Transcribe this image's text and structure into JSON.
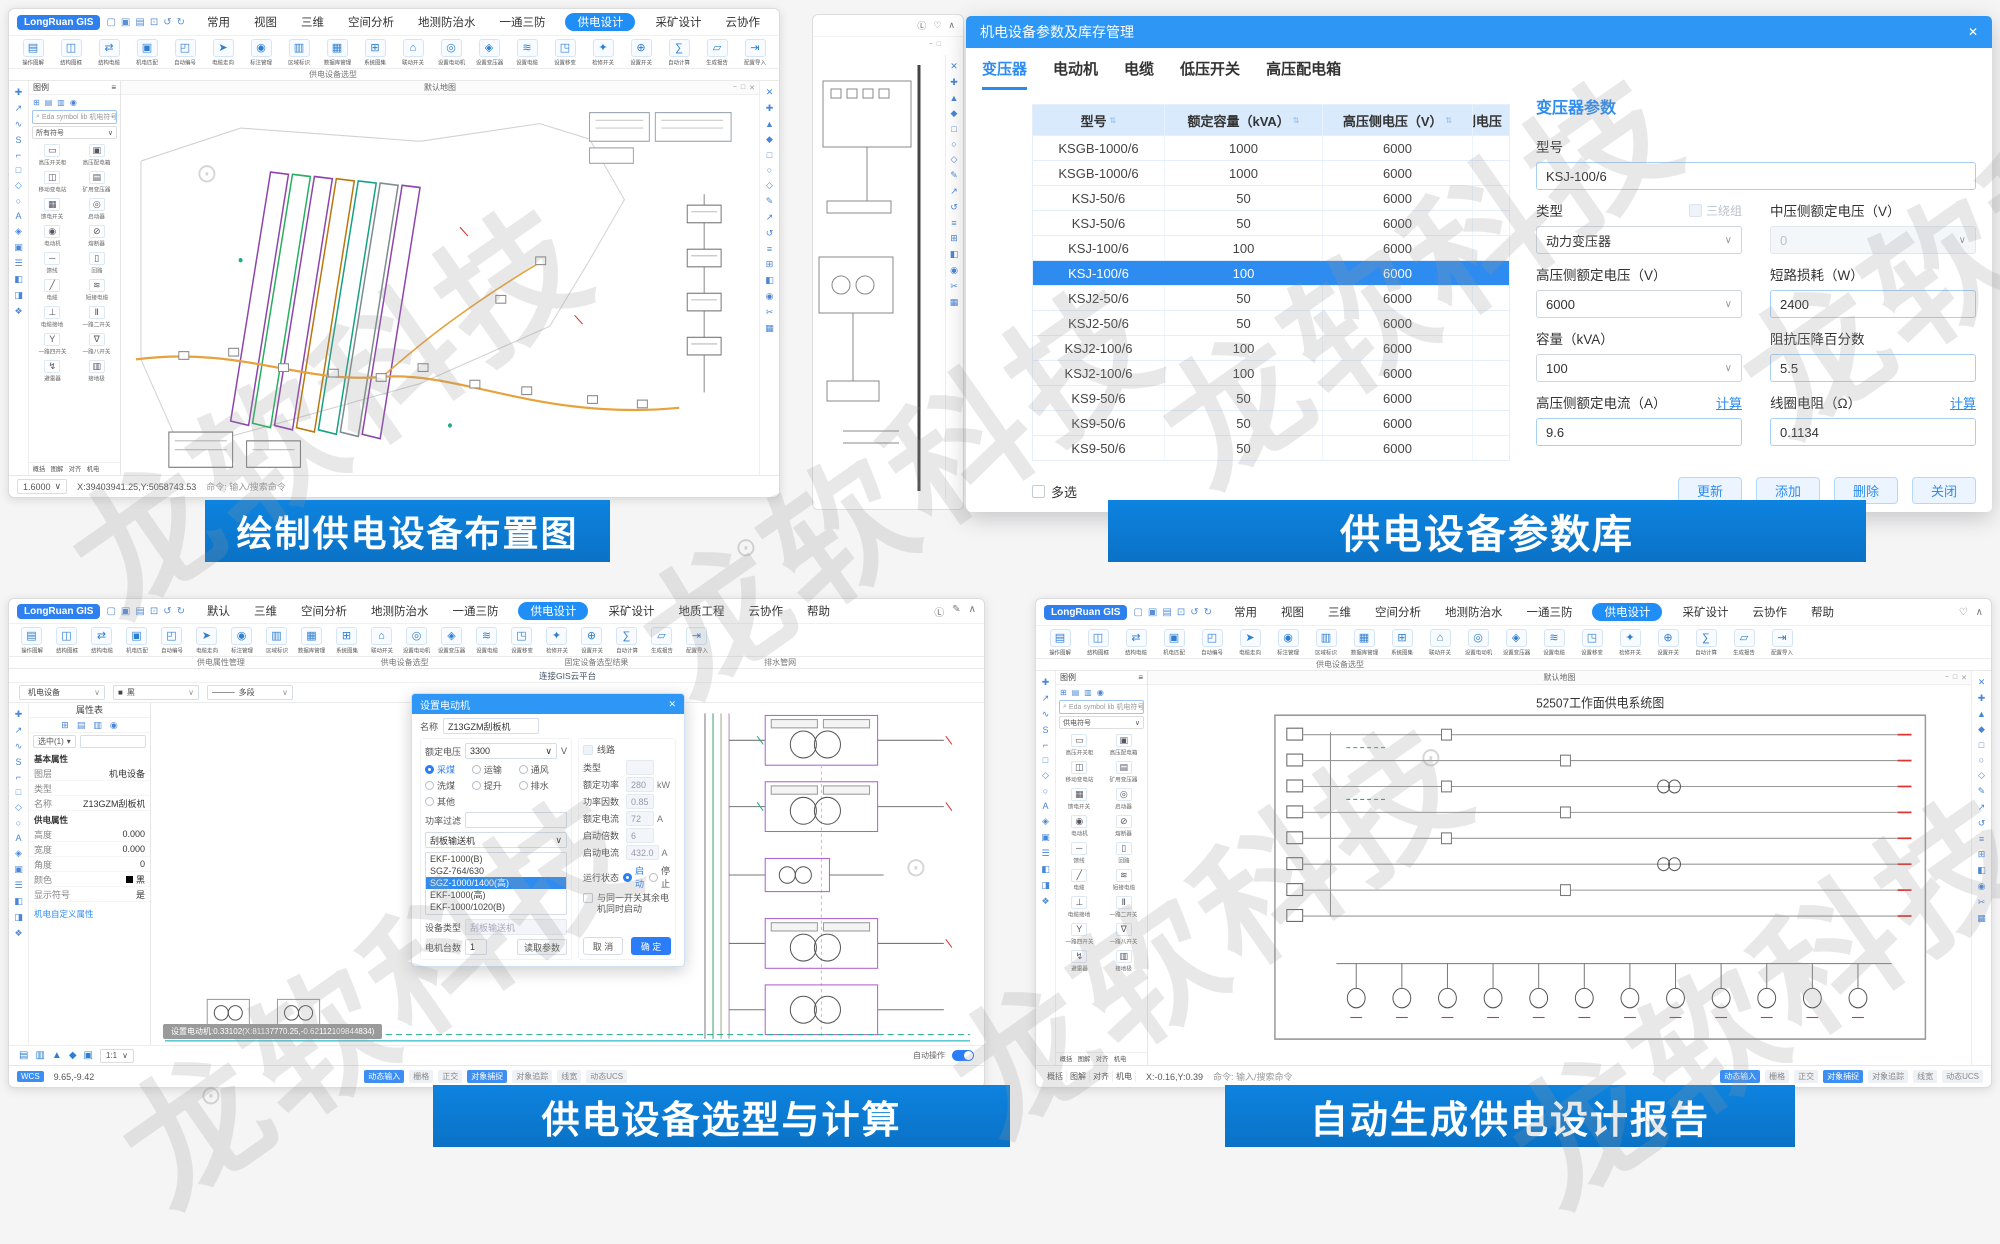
{
  "icons": {
    "caret": "∨",
    "close": "✕",
    "sort": "⇅",
    "minus": "−",
    "square": "□",
    "collapse": "∧",
    "search": "⌕",
    "tri": "▾",
    "reg": "⊙",
    "user": "Ⓛ",
    "heart": "♡"
  },
  "watermark": {
    "text": "龙软科技"
  },
  "captions": {
    "tl": "绘制供电设备布置图",
    "tr": "供电设备参数库",
    "bl": "供电设备选型与计算",
    "br": "自动生成供电设计报告"
  },
  "app": {
    "logo": "LongRuan GIS",
    "wctl": [
      "▢",
      "▣",
      "▤",
      "⊡",
      "↺",
      "↻"
    ],
    "menus_main": [
      {
        "label": "常用"
      },
      {
        "label": "视图"
      },
      {
        "label": "三维"
      },
      {
        "label": "空间分析"
      },
      {
        "label": "地测防治水"
      },
      {
        "label": "一通三防"
      },
      {
        "label": "供电设计",
        "active": true
      },
      {
        "label": "采矿设计"
      },
      {
        "label": "云协作"
      },
      {
        "label": "帮助"
      }
    ],
    "menus_bl": [
      {
        "label": "默认"
      },
      {
        "label": "三维"
      },
      {
        "label": "空间分析"
      },
      {
        "label": "地测防治水"
      },
      {
        "label": "一通三防"
      },
      {
        "label": "供电设计",
        "active": true
      },
      {
        "label": "采矿设计"
      },
      {
        "label": "地质工程"
      },
      {
        "label": "云协作"
      },
      {
        "label": "帮助"
      }
    ],
    "ribbon": [
      {
        "icon": "▤",
        "label": "操作图解"
      },
      {
        "icon": "◫",
        "label": "结构图框"
      },
      {
        "icon": "⇄",
        "label": "结构电缆"
      },
      {
        "icon": "▣",
        "label": "机电匹配"
      },
      {
        "icon": "◰",
        "label": "自动编号"
      },
      {
        "icon": "➤",
        "label": "电缆走向"
      },
      {
        "icon": "◉",
        "label": "标注管理"
      },
      {
        "icon": "▥",
        "label": "区域标识"
      },
      {
        "icon": "▦",
        "label": "数据库管理"
      },
      {
        "icon": "⊞",
        "label": "系统图集"
      },
      {
        "icon": "⌂",
        "label": "联动开关"
      },
      {
        "icon": "◎",
        "label": "设置电动机"
      },
      {
        "icon": "◈",
        "label": "设置变压器"
      },
      {
        "icon": "≋",
        "label": "设置电缆"
      },
      {
        "icon": "◳",
        "label": "设置移变"
      },
      {
        "icon": "✦",
        "label": "检修开关"
      },
      {
        "icon": "⊕",
        "label": "设置开关"
      },
      {
        "icon": "∑",
        "label": "自动计算"
      },
      {
        "icon": "▱",
        "label": "生成报告"
      },
      {
        "icon": "⇥",
        "label": "配置导入"
      }
    ],
    "ribbon_group": "供电设备选型",
    "strip_right": [
      "✕",
      "✚",
      "▲",
      "◆",
      "□",
      "○",
      "◇",
      "✎",
      "↗",
      "↺",
      "≡",
      "⊞",
      "◧",
      "◉",
      "✂",
      "▦"
    ],
    "strip_left": [
      "✚",
      "↗",
      "∿",
      "S",
      "⌐",
      "□",
      "◇",
      "○",
      "A",
      "◈",
      "▣",
      "☰",
      "◧",
      "◨",
      "❖"
    ],
    "pal_icons_row": [
      "⊞",
      "▤",
      "▥",
      "◉"
    ],
    "small_tabs": [
      "概括",
      "图解",
      "对齐",
      "机电"
    ],
    "status_tabs": [
      {
        "label": "动态输入",
        "on": true
      },
      {
        "label": "栅格"
      },
      {
        "label": "正交"
      },
      {
        "label": "对象捕捉",
        "on": true
      },
      {
        "label": "对象追踪"
      },
      {
        "label": "线宽"
      },
      {
        "label": "动态UCS"
      }
    ],
    "palette": {
      "header": "图例",
      "search": "Eda symbol lib 机电符号库",
      "items": [
        {
          "icon": "▭",
          "label": "高压开关柜"
        },
        {
          "icon": "▣",
          "label": "高压配电箱"
        },
        {
          "icon": "◫",
          "label": "移动变电站"
        },
        {
          "icon": "▤",
          "label": "矿用变压器"
        },
        {
          "icon": "▦",
          "label": "馈电开关"
        },
        {
          "icon": "◎",
          "label": "启动器"
        },
        {
          "icon": "◉",
          "label": "电动机"
        },
        {
          "icon": "⊘",
          "label": "熔断器"
        },
        {
          "icon": "─",
          "label": "馈线"
        },
        {
          "icon": "▯",
          "label": "回路"
        },
        {
          "icon": "╱",
          "label": "电缆"
        },
        {
          "icon": "≋",
          "label": "短接电缆"
        },
        {
          "icon": "⊥",
          "label": "电缆接地"
        },
        {
          "icon": "Ⅱ",
          "label": "一路二开关"
        },
        {
          "icon": "Y",
          "label": "一路四开关"
        },
        {
          "icon": "∇",
          "label": "一路八开关"
        },
        {
          "icon": "↯",
          "label": "避雷器"
        },
        {
          "icon": "▥",
          "label": "接地极"
        }
      ]
    }
  },
  "tl": {
    "palette_filter": "所有符号",
    "canvas": {
      "tab": "默认地图"
    },
    "status": {
      "scale": "1.6000",
      "coords": "X:39403941.25,Y:5058743.53",
      "cmd": "命令: 输入/搜索命令"
    }
  },
  "tr_panel": {
    "title": "机电设备参数及库存管理",
    "tabs": [
      {
        "label": "变压器",
        "active": true
      },
      {
        "label": "电动机"
      },
      {
        "label": "电缆"
      },
      {
        "label": "低压开关"
      },
      {
        "label": "高压配电箱"
      }
    ],
    "table": {
      "columns": [
        {
          "label": "型号"
        },
        {
          "label": "额定容量（kVA）"
        },
        {
          "label": "高压侧电压（V）"
        },
        {
          "label": "低压侧电压（V）"
        }
      ],
      "rows": [
        {
          "model": "KSGB-1000/6",
          "kva": "1000",
          "hv": "6000",
          "lv": ""
        },
        {
          "model": "KSGB-1000/6",
          "kva": "1000",
          "hv": "6000",
          "lv": ""
        },
        {
          "model": "KSJ-50/6",
          "kva": "50",
          "hv": "6000",
          "lv": ""
        },
        {
          "model": "KSJ-50/6",
          "kva": "50",
          "hv": "6000",
          "lv": ""
        },
        {
          "model": "KSJ-100/6",
          "kva": "100",
          "hv": "6000",
          "lv": ""
        },
        {
          "model": "KSJ-100/6",
          "kva": "100",
          "hv": "6000",
          "lv": "",
          "selected": true
        },
        {
          "model": "KSJ2-50/6",
          "kva": "50",
          "hv": "6000",
          "lv": ""
        },
        {
          "model": "KSJ2-50/6",
          "kva": "50",
          "hv": "6000",
          "lv": ""
        },
        {
          "model": "KSJ2-100/6",
          "kva": "100",
          "hv": "6000",
          "lv": ""
        },
        {
          "model": "KSJ2-100/6",
          "kva": "100",
          "hv": "6000",
          "lv": ""
        },
        {
          "model": "KS9-50/6",
          "kva": "50",
          "hv": "6000",
          "lv": ""
        },
        {
          "model": "KS9-50/6",
          "kva": "50",
          "hv": "6000",
          "lv": ""
        },
        {
          "model": "KS9-50/6",
          "kva": "50",
          "hv": "6000",
          "lv": ""
        }
      ]
    },
    "multi": "多选",
    "form": {
      "title": "变压器参数",
      "model_label": "型号",
      "model": "KSJ-100/6",
      "type_label": "类型",
      "three": "三绕组",
      "type": "动力变压器",
      "mv_label": "中压侧额定电压（V）",
      "mv": "0",
      "hv_label": "高压侧额定电压（V）",
      "hv": "6000",
      "loss_label": "短路损耗（W）",
      "loss": "2400",
      "cap_label": "容量（kVA）",
      "cap": "100",
      "imp_label": "阻抗压降百分数",
      "imp": "5.5",
      "cur_label": "高压侧额定电流（A）",
      "calc": "计算",
      "cur": "9.6",
      "res_label": "线圈电阻（Ω）",
      "res": "0.1134",
      "buttons": [
        "更新",
        "添加",
        "删除",
        "关闭"
      ]
    }
  },
  "bl": {
    "groups": [
      "供电属性管理",
      "供电设备选型",
      "固定设备选型结果",
      "排水管网"
    ],
    "toolbar": {
      "link": "连接GIS云平台",
      "selects": [
        {
          "pre": "",
          "label": "机电设备"
        },
        {
          "pre": "■",
          "label": "黑"
        },
        {
          "pre": "────",
          "label": "多段"
        }
      ]
    },
    "props": {
      "title": "属性表",
      "filter": "选中(1)",
      "sec1": "基本属性",
      "rows1": [
        {
          "k": "图层",
          "v": "机电设备"
        },
        {
          "k": "类型",
          "v": ""
        },
        {
          "k": "名称",
          "v": "Z13GZM刮板机"
        }
      ],
      "sec2": "供电属性",
      "rows2": [
        {
          "k": "高度",
          "v": "0.000"
        },
        {
          "k": "宽度",
          "v": "0.000"
        },
        {
          "k": "角度",
          "v": "0"
        },
        {
          "k": "颜色",
          "v": "黑",
          "swatch": true
        },
        {
          "k": "显示符号",
          "v": "是"
        }
      ],
      "link": "机电自定义属性"
    },
    "dialog": {
      "title": "设置电动机",
      "name_label": "名称",
      "name": "Z13GZM刮板机",
      "volt_label": "额定电压",
      "volt": "3300",
      "volt_unit": "V",
      "radios": [
        {
          "label": "采煤",
          "on": true
        },
        {
          "label": "运输"
        },
        {
          "label": "通风"
        },
        {
          "label": "洗煤"
        },
        {
          "label": "提升"
        },
        {
          "label": "排水"
        },
        {
          "label": "其他"
        }
      ],
      "filter_label": "功率过滤",
      "cat": "刮板输送机",
      "list": [
        {
          "label": "EKF-1000(B)"
        },
        {
          "label": "SGZ-764/630"
        },
        {
          "label": "SGZ-1000/1400(高)",
          "selected": true
        },
        {
          "label": "EKF-1000(高)"
        },
        {
          "label": "EKF-1000/1020(B)"
        },
        {
          "label": "EKF-1000HD(B)"
        },
        {
          "label": "JCJB-1380/500"
        }
      ],
      "devtype_label": "设备类型",
      "devtype": "刮板输送机",
      "count_label": "电机台数",
      "count": "1",
      "read_btn": "读取参数",
      "line_label": "线路",
      "rfields": [
        {
          "k": "类型",
          "v": "",
          "disabled": true
        },
        {
          "k": "额定功率",
          "v": "280",
          "u": "kW"
        },
        {
          "k": "功率因数",
          "v": "0.85",
          "u": ""
        },
        {
          "k": "额定电流",
          "v": "72",
          "u": "A"
        },
        {
          "k": "启动倍数",
          "v": "6",
          "u": ""
        },
        {
          "k": "启动电流",
          "v": "432.0",
          "u": "A"
        }
      ],
      "state_label": "运行状态",
      "state_on": "启动",
      "state_off": "停止",
      "sync_label": "与同一开关其余电机同时启动",
      "cancel": "取 消",
      "ok": "确 定"
    },
    "canvas": {
      "tooltip": "设置电动机:0.33102(X:81137770.25,-0.62112109844834)"
    },
    "bottom_icons": [
      "▤",
      "▥",
      "▲",
      "◆",
      "▣"
    ],
    "status": {
      "chip": "WCS",
      "coords": "9.65,-9.42",
      "zoom": "1:1",
      "auto": "自动操作"
    }
  },
  "br": {
    "palette_filter": "供电符号",
    "canvas": {
      "tab": "默认地图",
      "title": "52507工作面供电系统图"
    },
    "status": {
      "coords": "X:-0.16,Y:0.39",
      "cmd": "命令: 输入/搜索命令"
    }
  }
}
